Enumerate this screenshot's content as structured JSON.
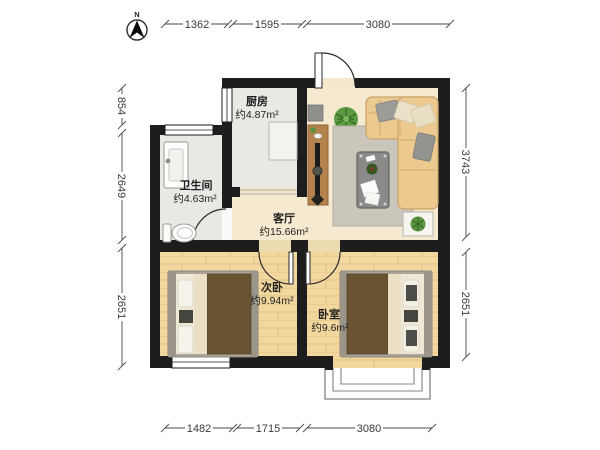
{
  "compass": {
    "label": "N"
  },
  "dimensions": {
    "top": [
      "1362",
      "1595",
      "3080"
    ],
    "bottom": [
      "1482",
      "1715",
      "3080"
    ],
    "left": [
      "854",
      "2649",
      "2651"
    ],
    "right": [
      "3743",
      "2651"
    ]
  },
  "rooms": {
    "kitchen": {
      "name": "厨房",
      "area": "约4.87m²"
    },
    "bathroom": {
      "name": "卫生间",
      "area": "约4.63m²"
    },
    "living_room": {
      "name": "客厅",
      "area": "约15.66m²"
    },
    "second_bedroom": {
      "name": "次卧",
      "area": "约9.94m²"
    },
    "master_bedroom": {
      "name": "卧室",
      "area": "约9.6m²"
    }
  },
  "colors": {
    "wall": "#1d1d1d",
    "wood_floor": "#f2d79e",
    "tile_floor": "#e9e8e4",
    "living_floor": "#f5ead0",
    "sofa": "#ebc98f",
    "bed_blanket": "#6a5332",
    "plant_green": "#5c9a42",
    "dimension_text": "#3a3a3a"
  }
}
